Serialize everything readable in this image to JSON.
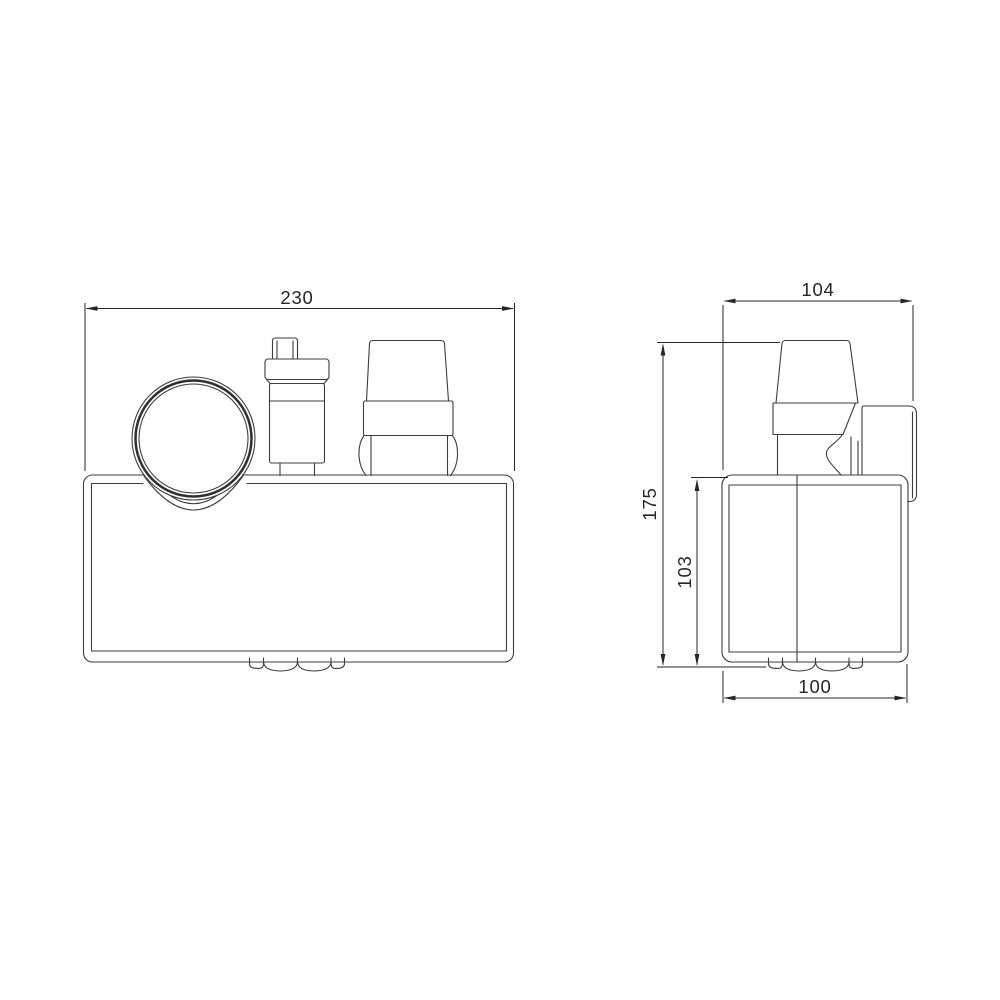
{
  "drawing": {
    "background": "#ffffff",
    "line_color": "#3d3d3d",
    "dimension_color": "#262626",
    "views": {
      "front_view": "front-view",
      "side_view": "side-view"
    },
    "dimensions": {
      "front_width": "230",
      "side_depth": "104",
      "side_overall_height": "175",
      "side_body_height": "103",
      "side_base_depth": "100"
    }
  }
}
